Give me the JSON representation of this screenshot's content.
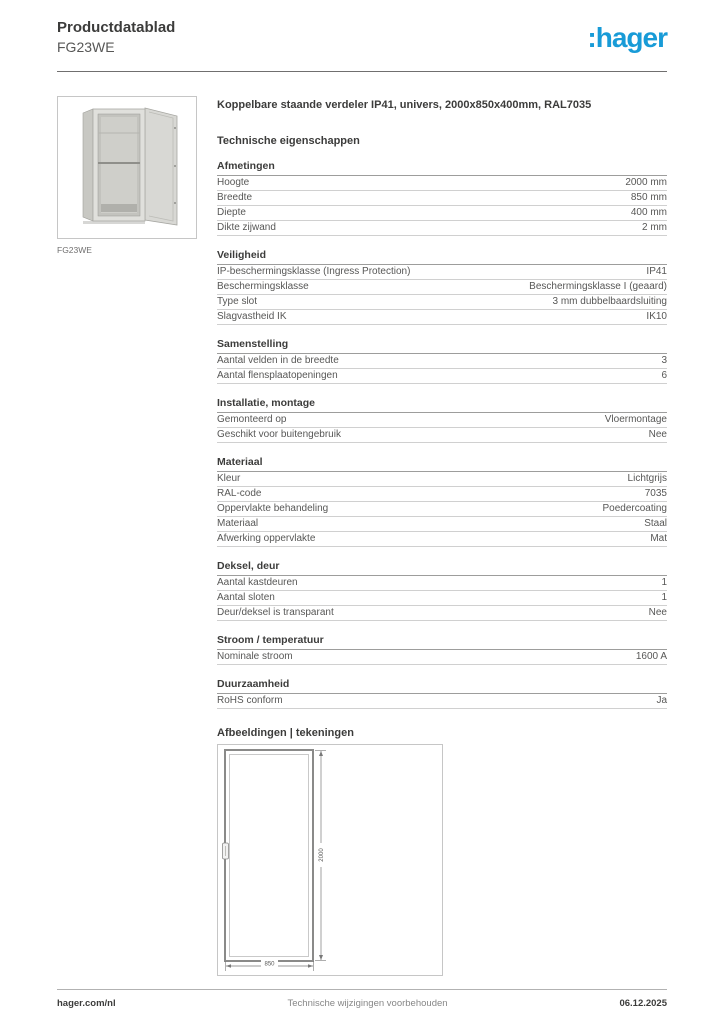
{
  "header": {
    "doc_type": "Productdatablad",
    "product_code": "FG23WE",
    "logo_text": ":hager",
    "brand_color": "#189bd7"
  },
  "product": {
    "title": "Koppelbare staande verdeler IP41, univers, 2000x850x400mm, RAL7035",
    "image_caption": "FG23WE"
  },
  "tech": {
    "heading": "Technische eigenschappen",
    "sections": [
      {
        "title": "Afmetingen",
        "rows": [
          {
            "label": "Hoogte",
            "value": "2000 mm"
          },
          {
            "label": "Breedte",
            "value": "850 mm"
          },
          {
            "label": "Diepte",
            "value": "400 mm"
          },
          {
            "label": "Dikte zijwand",
            "value": "2 mm"
          }
        ]
      },
      {
        "title": "Veiligheid",
        "rows": [
          {
            "label": "IP-beschermingsklasse (Ingress Protection)",
            "value": "IP41"
          },
          {
            "label": "Beschermingsklasse",
            "value": "Beschermingsklasse I (geaard)"
          },
          {
            "label": "Type slot",
            "value": "3 mm dubbelbaardsluiting"
          },
          {
            "label": "Slagvastheid IK",
            "value": "IK10"
          }
        ]
      },
      {
        "title": "Samenstelling",
        "rows": [
          {
            "label": "Aantal velden in de breedte",
            "value": "3"
          },
          {
            "label": "Aantal flensplaatopeningen",
            "value": "6"
          }
        ]
      },
      {
        "title": "Installatie, montage",
        "rows": [
          {
            "label": "Gemonteerd op",
            "value": "Vloermontage"
          },
          {
            "label": "Geschikt voor buitengebruik",
            "value": "Nee"
          }
        ]
      },
      {
        "title": "Materiaal",
        "rows": [
          {
            "label": "Kleur",
            "value": "Lichtgrijs"
          },
          {
            "label": "RAL-code",
            "value": "7035"
          },
          {
            "label": "Oppervlakte behandeling",
            "value": "Poedercoating"
          },
          {
            "label": "Materiaal",
            "value": "Staal"
          },
          {
            "label": "Afwerking oppervlakte",
            "value": "Mat"
          }
        ]
      },
      {
        "title": "Deksel, deur",
        "rows": [
          {
            "label": "Aantal kastdeuren",
            "value": "1"
          },
          {
            "label": "Aantal sloten",
            "value": "1"
          },
          {
            "label": "Deur/deksel is transparant",
            "value": "Nee"
          }
        ]
      },
      {
        "title": "Stroom / temperatuur",
        "rows": [
          {
            "label": "Nominale stroom",
            "value": "1600 A"
          }
        ]
      },
      {
        "title": "Duurzaamheid",
        "rows": [
          {
            "label": "RoHS conform",
            "value": "Ja"
          }
        ]
      }
    ]
  },
  "drawings": {
    "heading": "Afbeeldingen | tekeningen",
    "dimension_height": "2000",
    "dimension_width": "850"
  },
  "footer": {
    "website": "hager.com/nl",
    "disclaimer": "Technische wijzigingen voorbehouden",
    "date": "06.12.2025"
  }
}
